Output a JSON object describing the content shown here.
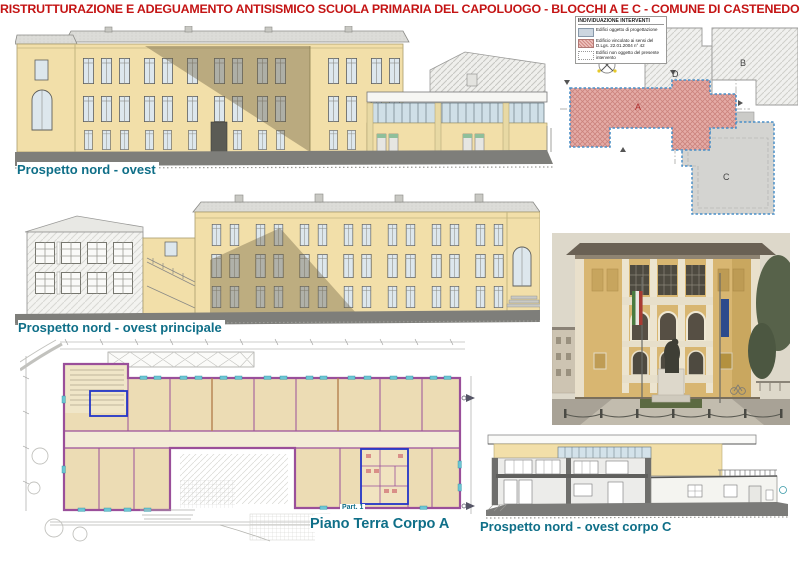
{
  "title": "RISTRUTTURAZIONE E ADEGUAMENTO ANTISISMICO SCUOLA PRIMARIA DEL CAPOLUOGO - BLOCCHI A E C - COMUNE DI CASTENEDOLO (BS)",
  "labels": {
    "top_elevation": "Prospetto nord - ovest",
    "main_elevation": "Prospetto nord - ovest principale",
    "floor_plan": "Piano Terra Corpo A",
    "floor_plan_detail": "Part. 1",
    "corpo_c_elevation": "Prospetto nord - ovest corpo C"
  },
  "key_plan": {
    "legend_title": "INDIVIDUAZIONE INTERVENTI",
    "legend_items": [
      {
        "swatch": "solid-blue-gray",
        "label": "Edifici oggetto di progettazione"
      },
      {
        "swatch": "pink-hatch",
        "label": "Edificio vincolato ai sensi del D.Lgs. 22.01.2004 n° 42"
      },
      {
        "swatch": "white-dotted",
        "label": "Edifici non oggetto del presente intervento"
      }
    ],
    "blocks": [
      {
        "label": "A"
      },
      {
        "label": "B"
      },
      {
        "label": "C"
      },
      {
        "label": "D"
      }
    ]
  },
  "colors": {
    "title_red": "#c41414",
    "label_teal": "#0f6f88",
    "facade_yellow": "#f2dfa9",
    "shadow_tan": "#6e6244",
    "block_a_pink": "#e5aca7",
    "key_plan_outline_blue": "#4a8fc7",
    "plan_wall_magenta": "#9a4f9a",
    "plan_opening_teal": "#6cc6d4",
    "plan_room_beige": "#ecdcb4",
    "highlight_blue": "#2336c8",
    "ground_gray": "#7e7e7a"
  }
}
